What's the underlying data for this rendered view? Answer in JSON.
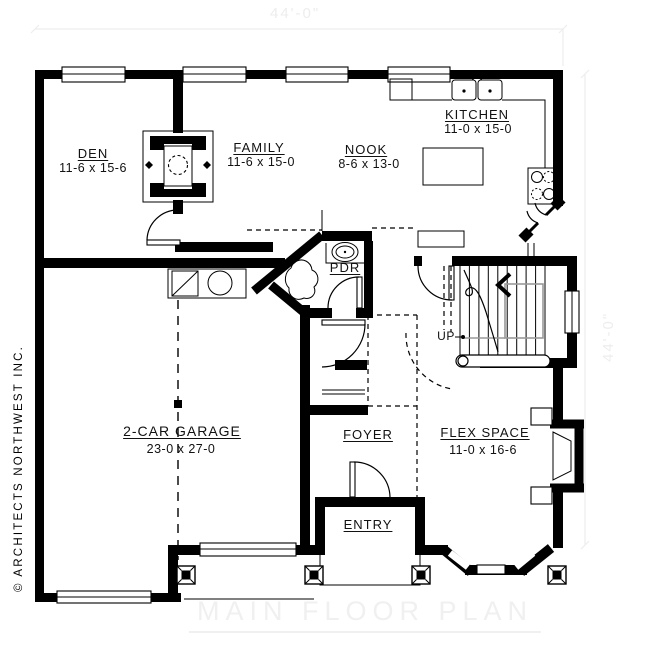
{
  "sheet": {
    "watermark": "MAIN FLOOR PLAN",
    "copyright": "© ARCHITECTS NORTHWEST INC."
  },
  "dimensions": {
    "top": "44'-0\"",
    "right": "44'-0\""
  },
  "rooms": {
    "den": {
      "name": "DEN",
      "size": "11-6 x 15-6"
    },
    "family": {
      "name": "FAMILY",
      "size": "11-6 x 15-0"
    },
    "nook": {
      "name": "NOOK",
      "size": "8-6 x 13-0"
    },
    "kitchen": {
      "name": "KITCHEN",
      "size": "11-0 x 15-0"
    },
    "pdr": {
      "name": "PDR"
    },
    "garage": {
      "name": "2-CAR GARAGE",
      "size": "23-0 x 27-0"
    },
    "foyer": {
      "name": "FOYER"
    },
    "entry": {
      "name": "ENTRY"
    },
    "flex": {
      "name": "FLEX SPACE",
      "size": "11-0 x 16-6"
    }
  },
  "stairs": {
    "direction_label": "UP"
  },
  "colors": {
    "wall": "#000000",
    "background": "#ffffff",
    "watermark": "#f0f0f0",
    "dimension": "#ededed",
    "handrail": "#999999",
    "ink": "#111111"
  }
}
